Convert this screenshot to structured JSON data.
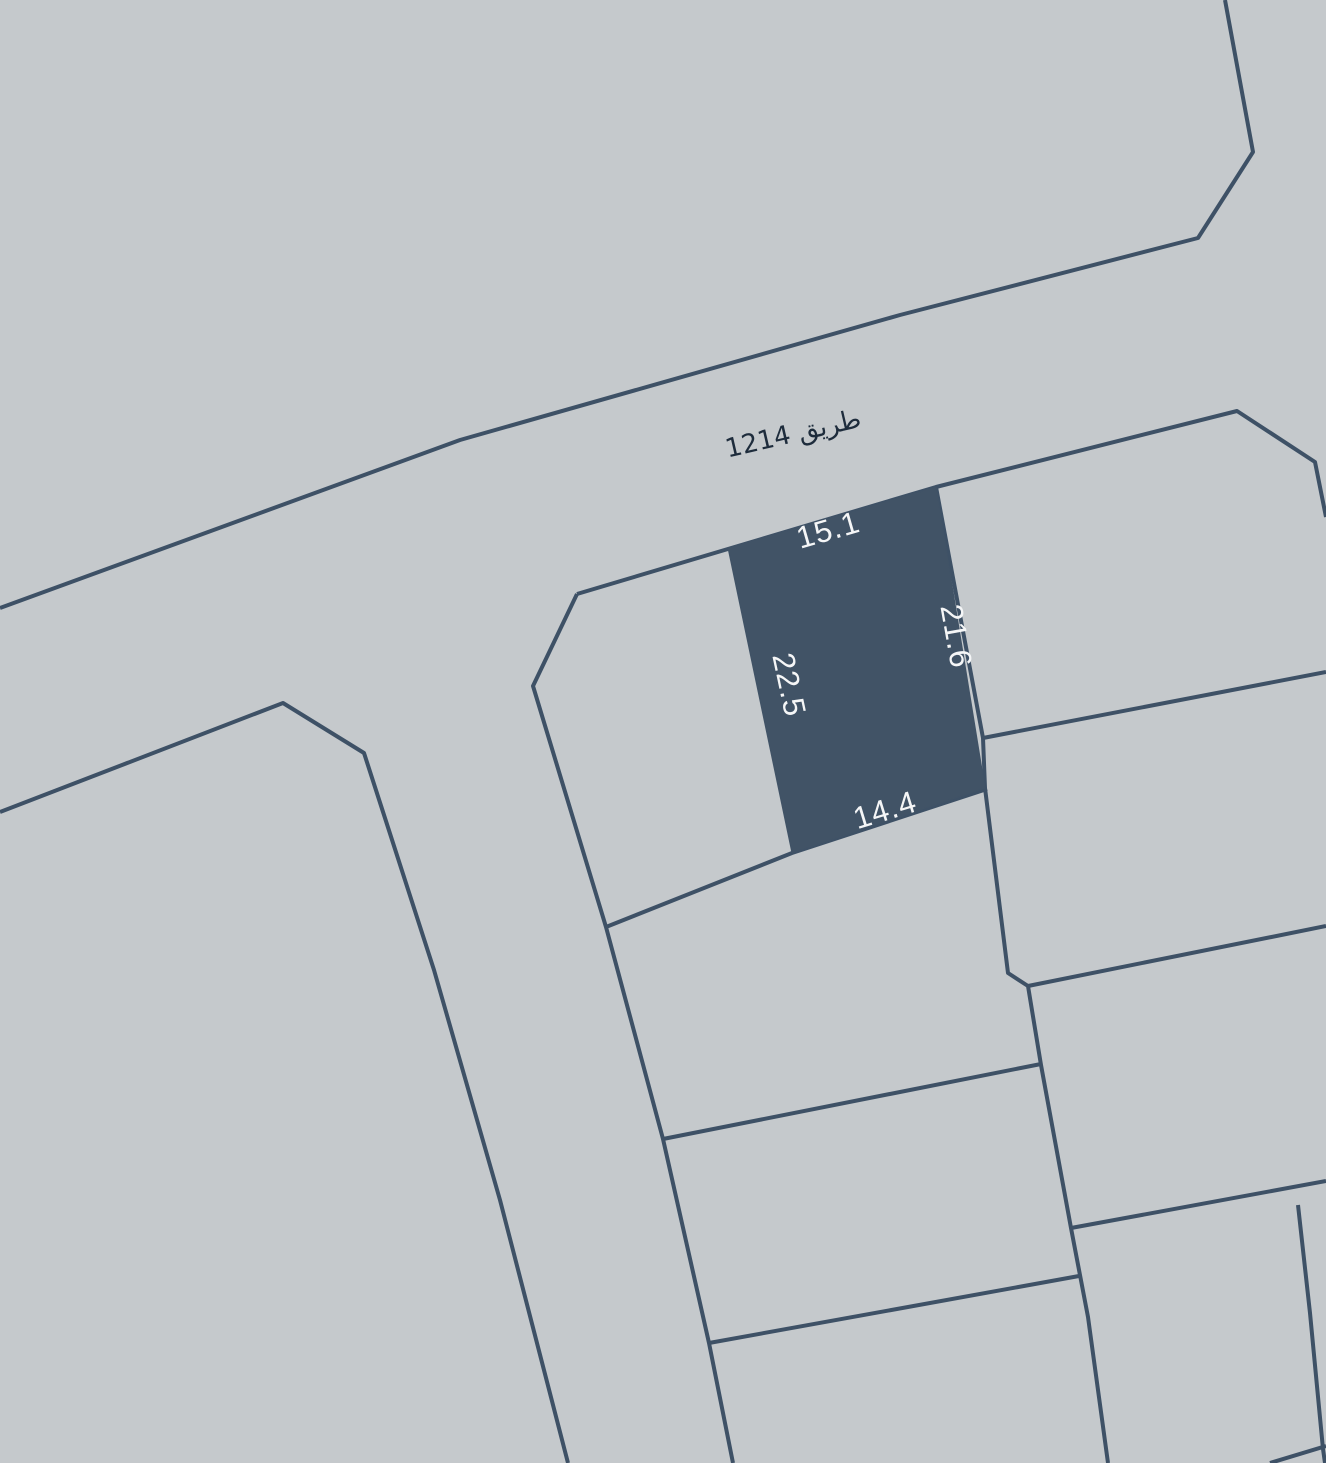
{
  "map": {
    "background_color": "#c5c9cc",
    "line_color": "#3e5166",
    "line_width": 4,
    "width": 1326,
    "height": 1463,
    "boundaries": [
      {
        "name": "road-north-boundary",
        "points": [
          [
            0,
            608
          ],
          [
            460,
            440
          ],
          [
            900,
            315
          ],
          [
            1198,
            238
          ],
          [
            1253,
            152
          ],
          [
            1225,
            0
          ]
        ]
      },
      {
        "name": "road-south-boundary",
        "points": [
          [
            577,
            594
          ],
          [
            936,
            487
          ],
          [
            1237,
            411
          ],
          [
            1315,
            462
          ],
          [
            1326,
            517
          ]
        ]
      },
      {
        "name": "west-road-boundary",
        "points": [
          [
            0,
            812
          ],
          [
            283,
            703
          ],
          [
            364,
            753
          ],
          [
            434,
            970
          ],
          [
            500,
            1200
          ],
          [
            568,
            1463
          ]
        ]
      },
      {
        "name": "block-west-boundary",
        "points": [
          [
            577,
            594
          ],
          [
            533,
            686
          ],
          [
            606,
            927
          ],
          [
            663,
            1139
          ],
          [
            709,
            1343
          ],
          [
            733,
            1463
          ]
        ]
      },
      {
        "name": "block-middle-vertical",
        "points": [
          [
            936,
            487
          ],
          [
            983,
            738
          ],
          [
            985,
            788
          ],
          [
            1008,
            973
          ],
          [
            1028,
            986
          ],
          [
            1041,
            1065
          ],
          [
            1071,
            1228
          ],
          [
            1088,
            1317
          ],
          [
            1108,
            1463
          ]
        ]
      },
      {
        "name": "divider-below-parcel",
        "points": [
          [
            606,
            927
          ],
          [
            792,
            853
          ],
          [
            987,
            789
          ]
        ]
      },
      {
        "name": "divider-west-2",
        "points": [
          [
            663,
            1139
          ],
          [
            1041,
            1064
          ]
        ]
      },
      {
        "name": "divider-west-3",
        "points": [
          [
            709,
            1343
          ],
          [
            1079,
            1276
          ]
        ]
      },
      {
        "name": "divider-east-1",
        "points": [
          [
            983,
            738
          ],
          [
            1326,
            672
          ]
        ]
      },
      {
        "name": "divider-east-2",
        "points": [
          [
            1028,
            986
          ],
          [
            1326,
            926
          ]
        ]
      },
      {
        "name": "divider-east-3",
        "points": [
          [
            1071,
            1228
          ],
          [
            1326,
            1181
          ]
        ]
      },
      {
        "name": "sliver-boundary",
        "points": [
          [
            1298,
            1205
          ],
          [
            1310,
            1313
          ],
          [
            1323,
            1449
          ],
          [
            1325,
            1463
          ]
        ]
      },
      {
        "name": "corner-segment",
        "points": [
          [
            1270,
            1463
          ],
          [
            1326,
            1446
          ]
        ]
      }
    ]
  },
  "road": {
    "label": "طريق 1214",
    "label_color": "#1e2c3c",
    "position": {
      "x": 795,
      "y": 442,
      "rotate": -13
    }
  },
  "parcel": {
    "fill_color": "#415366",
    "points": [
      [
        728,
        548
      ],
      [
        936,
        487
      ],
      [
        985,
        788
      ],
      [
        792,
        853
      ]
    ],
    "label_color": "#f5f6f7",
    "dimensions": {
      "top": "15.1",
      "right": "21.6",
      "bottom": "14.4",
      "left": "22.5"
    },
    "labels": [
      {
        "side": "top",
        "value": "15.1",
        "x": 831,
        "y": 540,
        "rotate": -16
      },
      {
        "side": "right",
        "value": "21.6",
        "x": 946,
        "y": 638,
        "rotate": 80
      },
      {
        "side": "left",
        "value": "22.5",
        "x": 779,
        "y": 687,
        "rotate": 78
      },
      {
        "side": "bottom",
        "value": "14.4",
        "x": 888,
        "y": 820,
        "rotate": -17
      }
    ]
  }
}
